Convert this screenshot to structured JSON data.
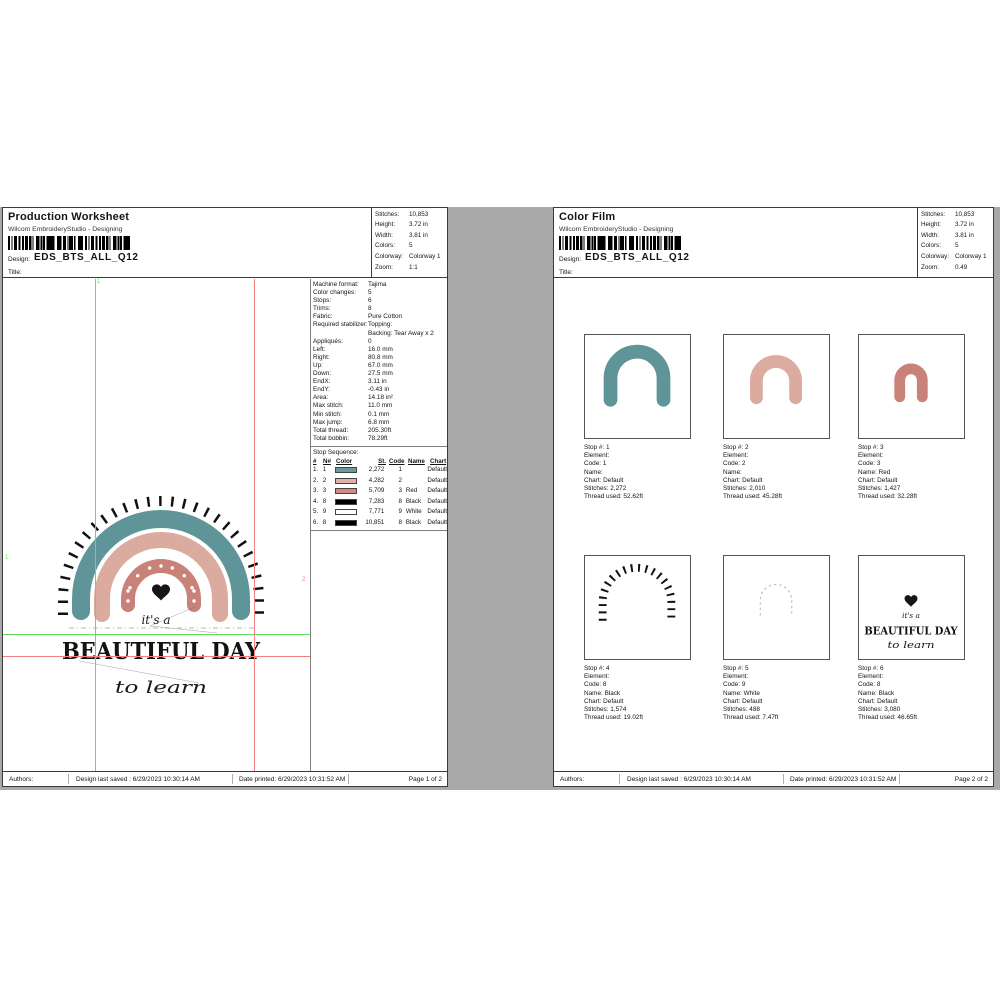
{
  "colors": {
    "workspace_bg": "#a9a9a9",
    "teal": "#5f9598",
    "pink": "#dcab9f",
    "red": "#c9827a",
    "guide_green": "#5ee05e",
    "guide_red": "#f28080"
  },
  "shared": {
    "subtitle": "Wilcom EmbroideryStudio - Designing",
    "design_label": "Design:",
    "design_name": "EDS_BTS_ALL_Q12",
    "title_label": "Title:",
    "footer": {
      "authors": "Authors:",
      "last_saved": "Design last saved : 6/29/2023 10:30:14 AM",
      "date_printed": "Date printed: 6/29/2023 10:31:52 AM"
    }
  },
  "left_page": {
    "title": "Production Worksheet",
    "info_box": [
      {
        "label": "Stitches:",
        "value": "10,853"
      },
      {
        "label": "Height:",
        "value": "3.72 in"
      },
      {
        "label": "Width:",
        "value": "3.81 in"
      },
      {
        "label": "Colors:",
        "value": "5"
      },
      {
        "label": "Colorway:",
        "value": "Colorway 1"
      },
      {
        "label": "Zoom:",
        "value": "1:1"
      }
    ],
    "machine_info": [
      {
        "label": "Machine format:",
        "value": "Tajima"
      },
      {
        "label": "Color changes:",
        "value": "5"
      },
      {
        "label": "Stops:",
        "value": "6"
      },
      {
        "label": "Trims:",
        "value": "8"
      },
      {
        "label": "Fabric:",
        "value": "Pure Cotton"
      },
      {
        "label": "Required stabilizer:",
        "value": "Topping:"
      },
      {
        "label": "",
        "value": "Backing: Tear Away x 2"
      },
      {
        "label": "Appliqués:",
        "value": "0"
      },
      {
        "label": "Left:",
        "value": "16.0 mm"
      },
      {
        "label": "Right:",
        "value": "80.8 mm"
      },
      {
        "label": "Up:",
        "value": "67.0 mm"
      },
      {
        "label": "Down:",
        "value": "27.5 mm"
      },
      {
        "label": "EndX:",
        "value": "3.11 in"
      },
      {
        "label": "EndY:",
        "value": "-0.43 in"
      },
      {
        "label": "Area:",
        "value": "14.18 in²"
      },
      {
        "label": "Max stitch:",
        "value": "11.0 mm"
      },
      {
        "label": "Min stitch:",
        "value": "0.1 mm"
      },
      {
        "label": "Max jump:",
        "value": "6.8 mm"
      },
      {
        "label": "Total thread:",
        "value": "205.30ft"
      },
      {
        "label": "Total bobbin:",
        "value": "78.29ft"
      }
    ],
    "stop_sequence_label": "Stop Sequence:",
    "stop_headers": [
      "#",
      "N#",
      "Color",
      "St.",
      "Code",
      "Name",
      "Chart"
    ],
    "stop_rows": [
      {
        "n": "1.",
        "n2": "1",
        "swatch": "#68999c",
        "st": "2,272",
        "code": "1",
        "name": "",
        "chart": "Default"
      },
      {
        "n": "2.",
        "n2": "2",
        "swatch": "#e2b2a9",
        "st": "4,282",
        "code": "2",
        "name": "",
        "chart": "Default"
      },
      {
        "n": "3.",
        "n2": "3",
        "swatch": "#d4887e",
        "st": "5,709",
        "code": "3",
        "name": "Red",
        "chart": "Default"
      },
      {
        "n": "4.",
        "n2": "8",
        "swatch": "#000000",
        "st": "7,283",
        "code": "8",
        "name": "Black",
        "chart": "Default"
      },
      {
        "n": "5.",
        "n2": "9",
        "swatch": "#ffffff",
        "st": "7,771",
        "code": "9",
        "name": "White",
        "chart": "Default"
      },
      {
        "n": "6.",
        "n2": "8",
        "swatch": "#000000",
        "st": "10,851",
        "code": "8",
        "name": "Black",
        "chart": "Default"
      }
    ],
    "guide_labels": {
      "v_green": "1",
      "h_green": "1",
      "h_red": "2"
    },
    "page_num": "Page 1 of 2"
  },
  "right_page": {
    "title": "Color Film",
    "info_box": [
      {
        "label": "Stitches:",
        "value": "10,853"
      },
      {
        "label": "Height:",
        "value": "3.72 in"
      },
      {
        "label": "Width:",
        "value": "3.81 in"
      },
      {
        "label": "Colors:",
        "value": "5"
      },
      {
        "label": "Colorway:",
        "value": "Colorway 1"
      },
      {
        "label": "Zoom:",
        "value": "0.49"
      }
    ],
    "stops": [
      {
        "lines": [
          "Stop #: 1",
          "Element:",
          "Code: 1",
          "Name:",
          "Chart: Default",
          "Stitches: 2,272",
          "Thread used: 52.62ft"
        ]
      },
      {
        "lines": [
          "Stop #: 2",
          "Element:",
          "Code: 2",
          "Name:",
          "Chart: Default",
          "Stitches: 2,010",
          "Thread used: 45.28ft"
        ]
      },
      {
        "lines": [
          "Stop #: 3",
          "Element:",
          "Code: 3",
          "Name: Red",
          "Chart: Default",
          "Stitches: 1,427",
          "Thread used: 32.28ft"
        ]
      },
      {
        "lines": [
          "Stop #: 4",
          "Element:",
          "Code: 8",
          "Name: Black",
          "Chart: Default",
          "Stitches: 1,574",
          "Thread used: 19.02ft"
        ]
      },
      {
        "lines": [
          "Stop #: 5",
          "Element:",
          "Code: 9",
          "Name: White",
          "Chart: Default",
          "Stitches: 488",
          "Thread used: 7.47ft"
        ]
      },
      {
        "lines": [
          "Stop #: 6",
          "Element:",
          "Code: 8",
          "Name: Black",
          "Chart: Default",
          "Stitches: 3,080",
          "Thread used: 46.65ft"
        ]
      }
    ],
    "page_num": "Page 2 of 2"
  },
  "design": {
    "its_a": "it's a",
    "headline": "BEAUTIFUL DAY",
    "to_learn": "to learn"
  }
}
